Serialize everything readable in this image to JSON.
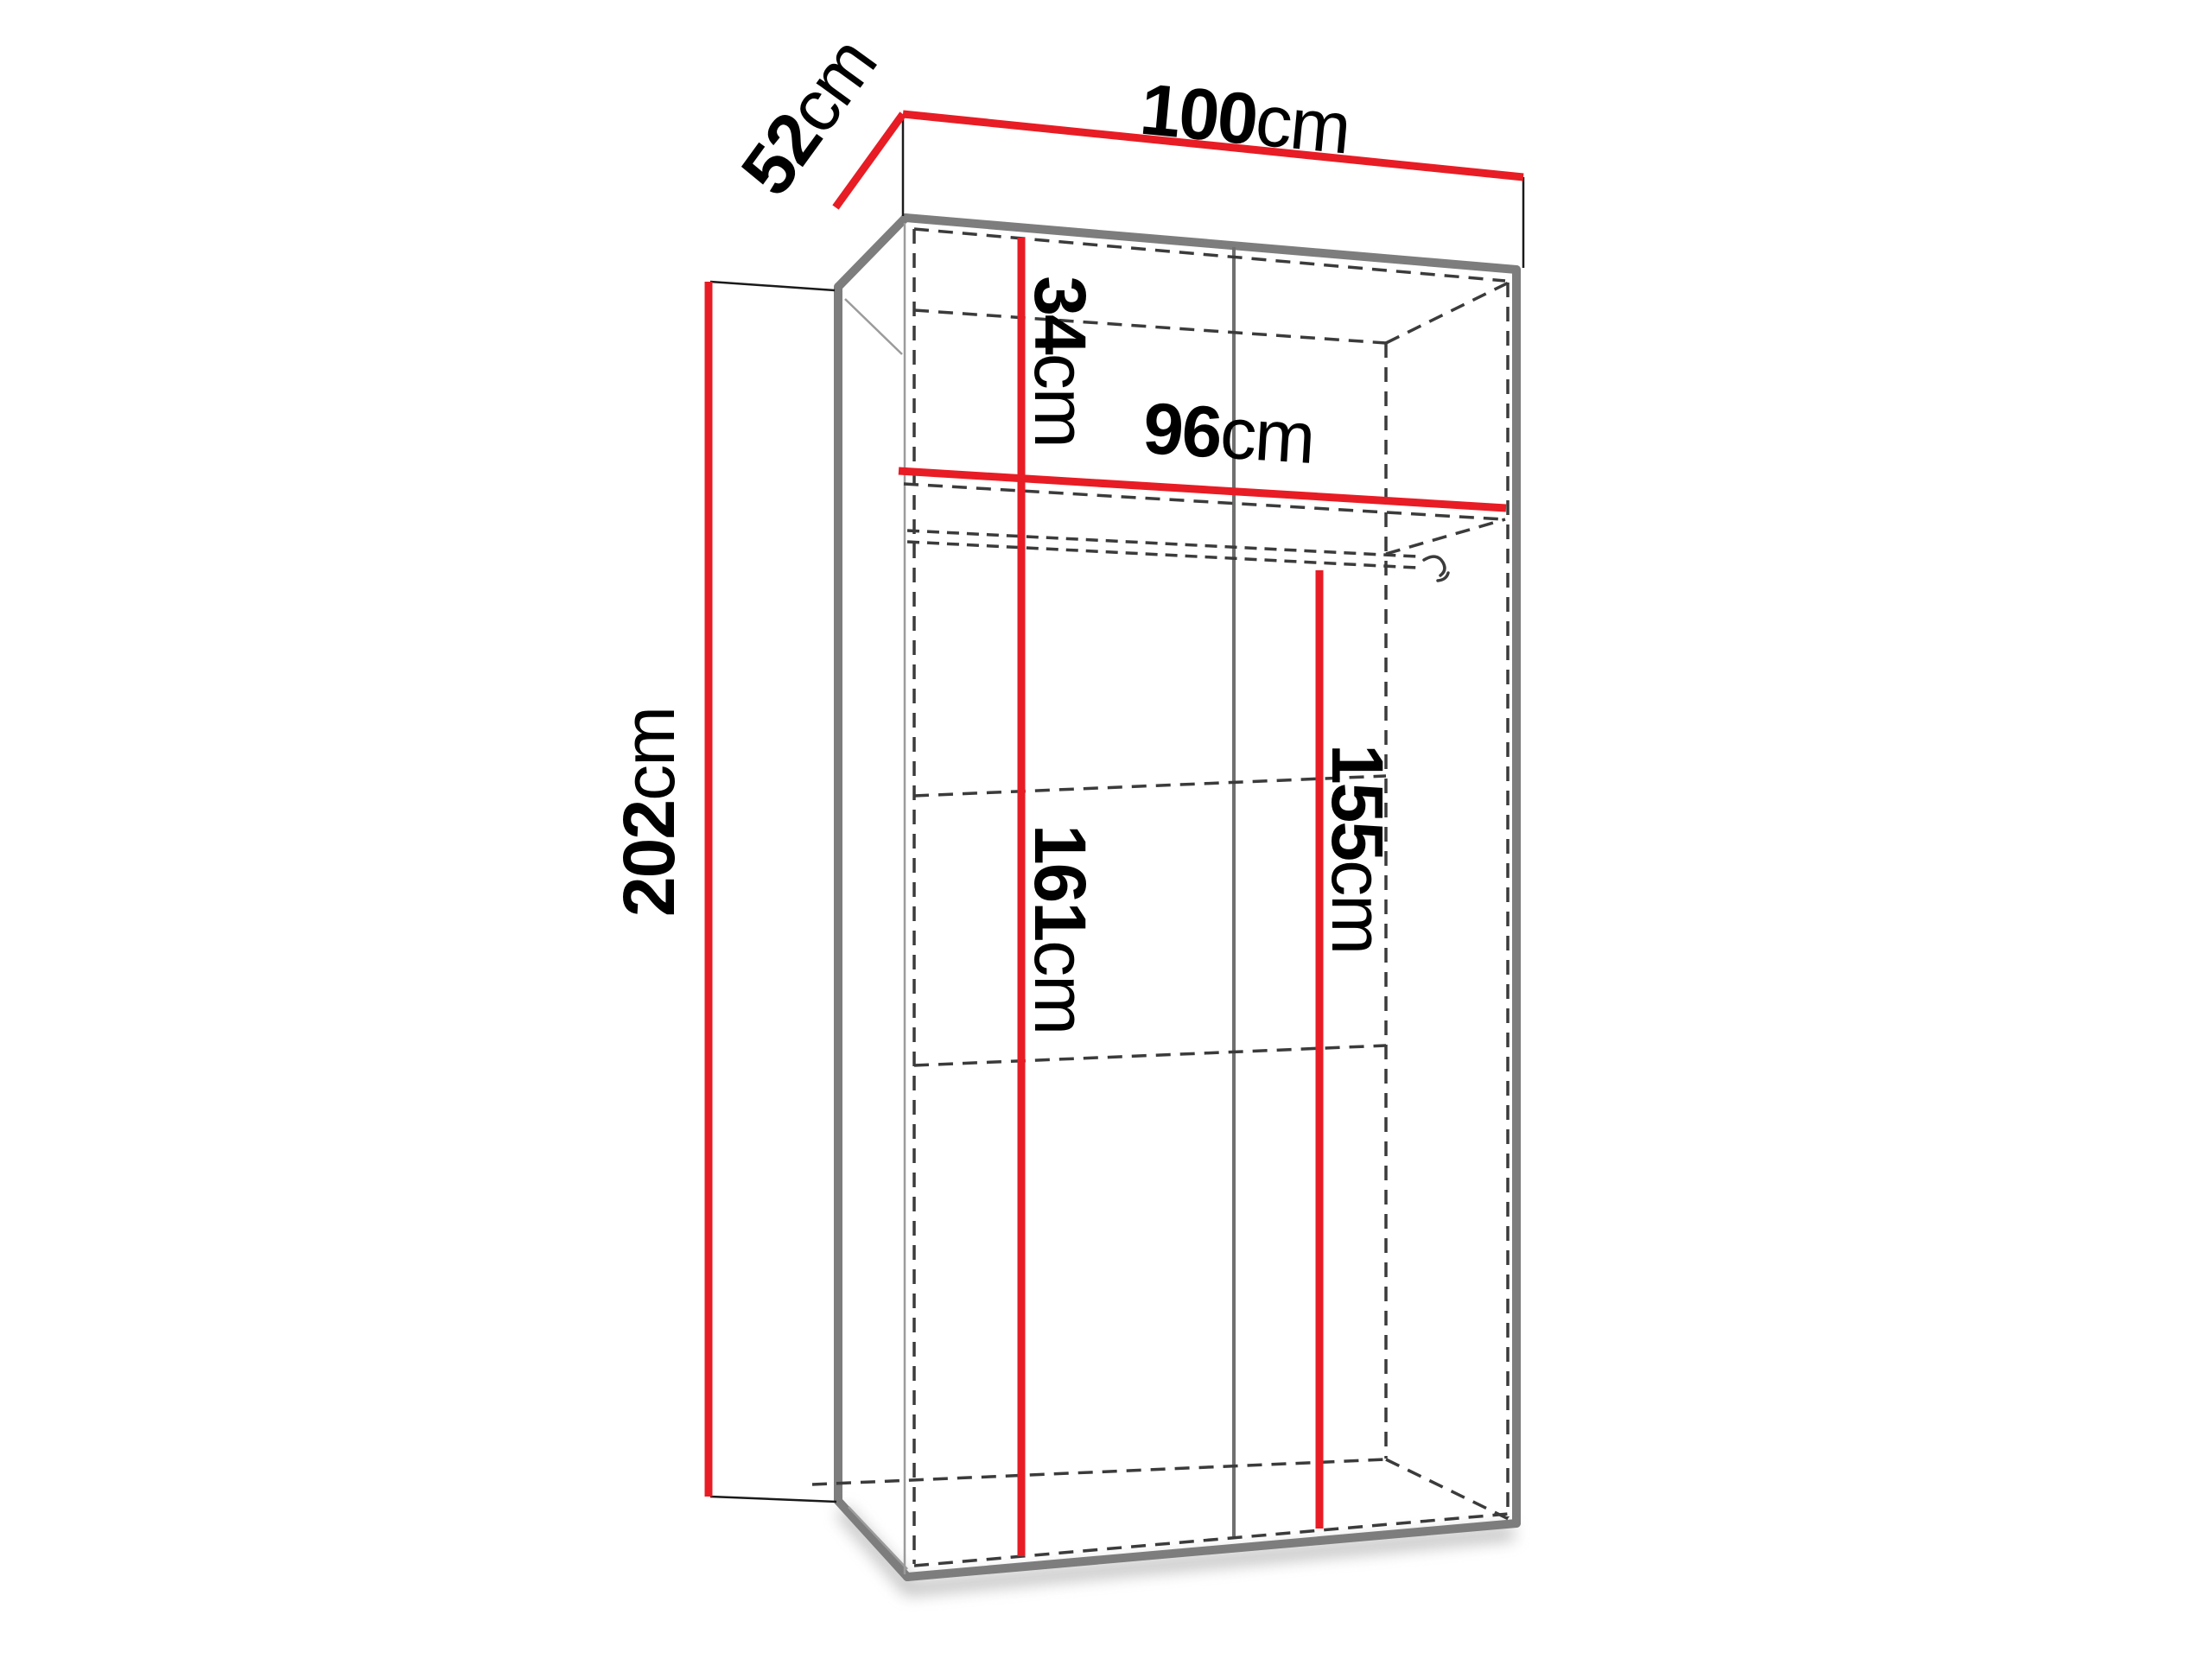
{
  "diagram": {
    "subject": "wardrobe-dimension-diagram",
    "unit": "cm"
  },
  "labels": {
    "top_width": {
      "value": "100",
      "unit": "cm"
    },
    "top_depth": {
      "value": "52",
      "unit": "cm"
    },
    "side_height": {
      "value": "202",
      "unit": "cm"
    },
    "upper_compartment_height": {
      "value": "34",
      "unit": "cm"
    },
    "inner_width": {
      "value": "96",
      "unit": "cm"
    },
    "left_inner_height": {
      "value": "161",
      "unit": "cm"
    },
    "right_inner_height": {
      "value": "155",
      "unit": "cm"
    }
  },
  "colors": {
    "dimension_line": "#e81c24",
    "cabinet_edge": "#7d7d7d",
    "inner_edge": "#9b9b9b",
    "divider": "#6f6f6f",
    "dashed_line": "#3b3b3b",
    "witness_line": "#1a1a1a",
    "text": "#000000",
    "background": "#ffffff",
    "shadow": "#8a8a8a"
  }
}
